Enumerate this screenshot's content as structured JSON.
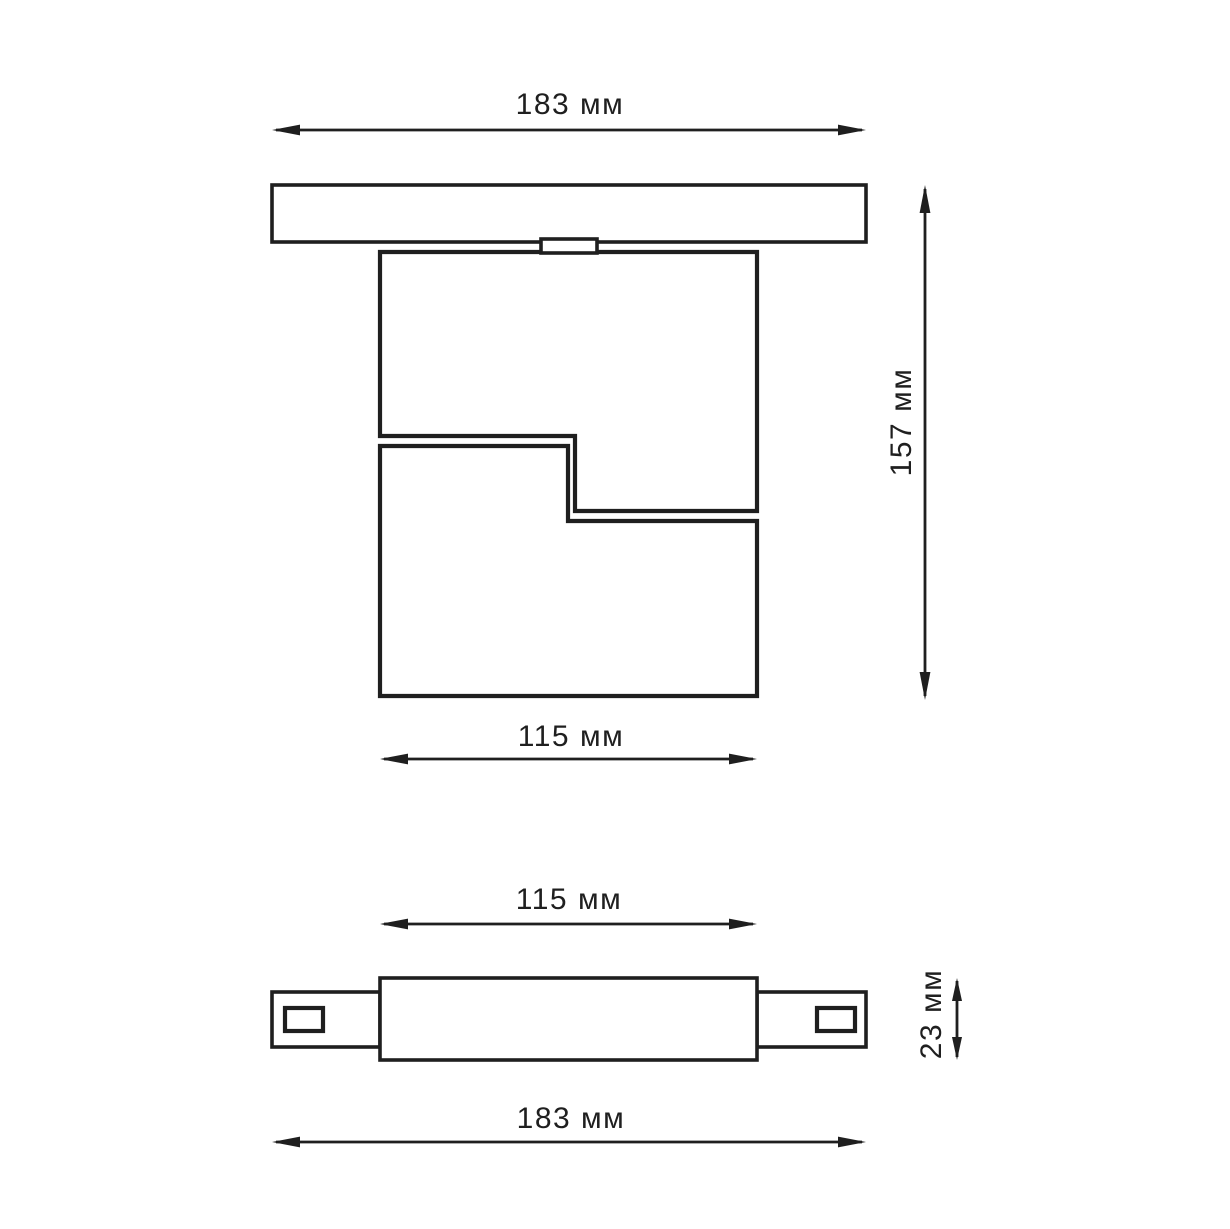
{
  "drawing": {
    "background": "#ffffff",
    "line_color": "#1f1f1f",
    "front_view": {
      "track_width": "183 мм",
      "height": "157 мм",
      "body_width": "115 мм"
    },
    "side_view": {
      "body_width": "115 мм",
      "height": "23 мм",
      "track_width": "183 мм"
    }
  }
}
